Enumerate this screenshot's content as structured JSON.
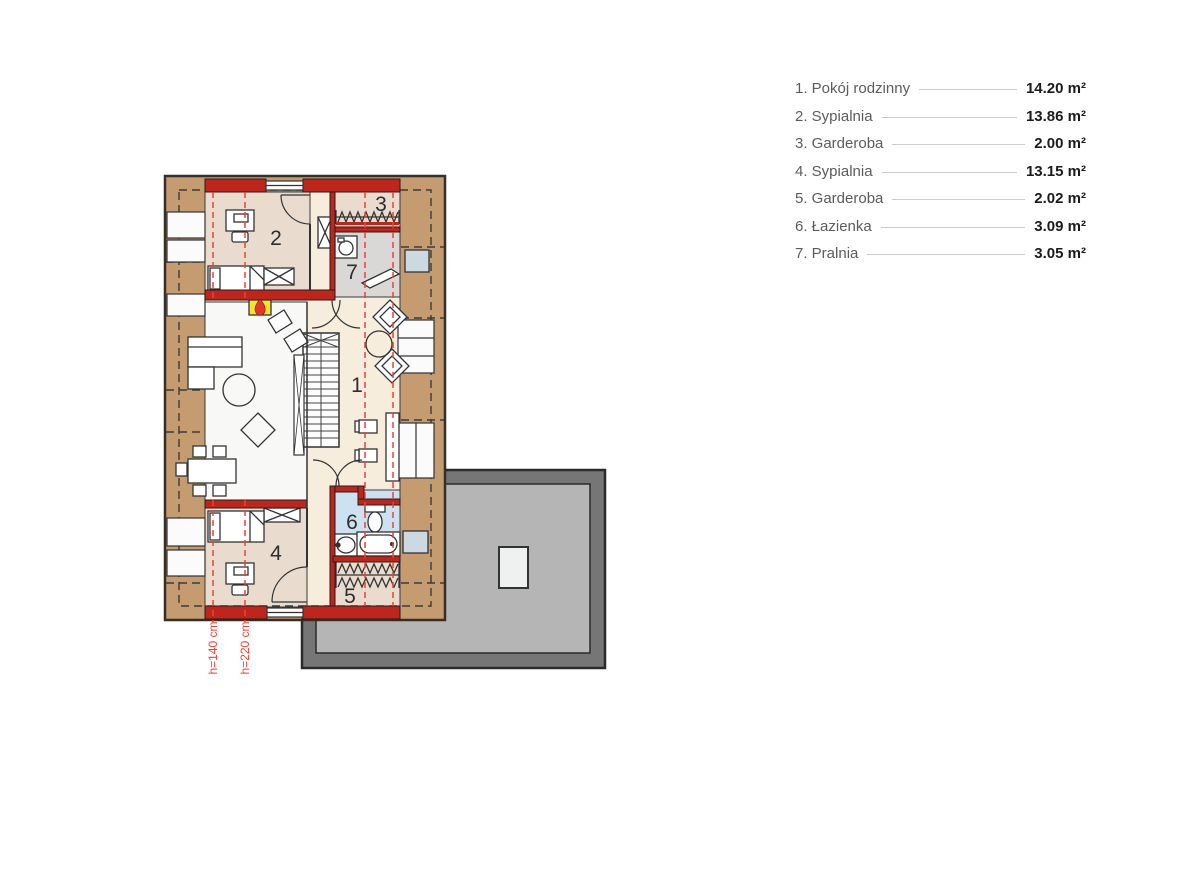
{
  "legend": {
    "items": [
      {
        "label": "1. Pokój rodzinny",
        "area": "14.20 m²"
      },
      {
        "label": "2. Sypialnia",
        "area": "13.86 m²"
      },
      {
        "label": "3. Garderoba",
        "area": "2.00 m²"
      },
      {
        "label": "4. Sypialnia",
        "area": "13.15 m²"
      },
      {
        "label": "5. Garderoba",
        "area": "2.02 m²"
      },
      {
        "label": "6. Łazienka",
        "area": "3.09 m²"
      },
      {
        "label": "7. Pralnia",
        "area": "3.05 m²"
      }
    ]
  },
  "plan": {
    "rooms": {
      "r1": "1",
      "r2": "2",
      "r3": "3",
      "r4": "4",
      "r5": "5",
      "r6": "6",
      "r7": "7"
    },
    "heights": {
      "h140": "h=140 cm",
      "h220": "h=220 cm"
    },
    "colors": {
      "roof_band": "#c49c70",
      "wall": "#c0251c",
      "floor_beige": "#e9dccf",
      "floor_cream": "#f6eddc",
      "floor_gray": "#d9d8d6",
      "floor_blue": "#cde2f1",
      "floor_void": "#f8f8f7",
      "roof_outer": "#767676",
      "roof_inner": "#b5b5b5",
      "skylight": "#eff1f1",
      "roof_window": "#ccd9e3",
      "chimney": "#f5e32e",
      "height_line": "#ee4135"
    }
  }
}
